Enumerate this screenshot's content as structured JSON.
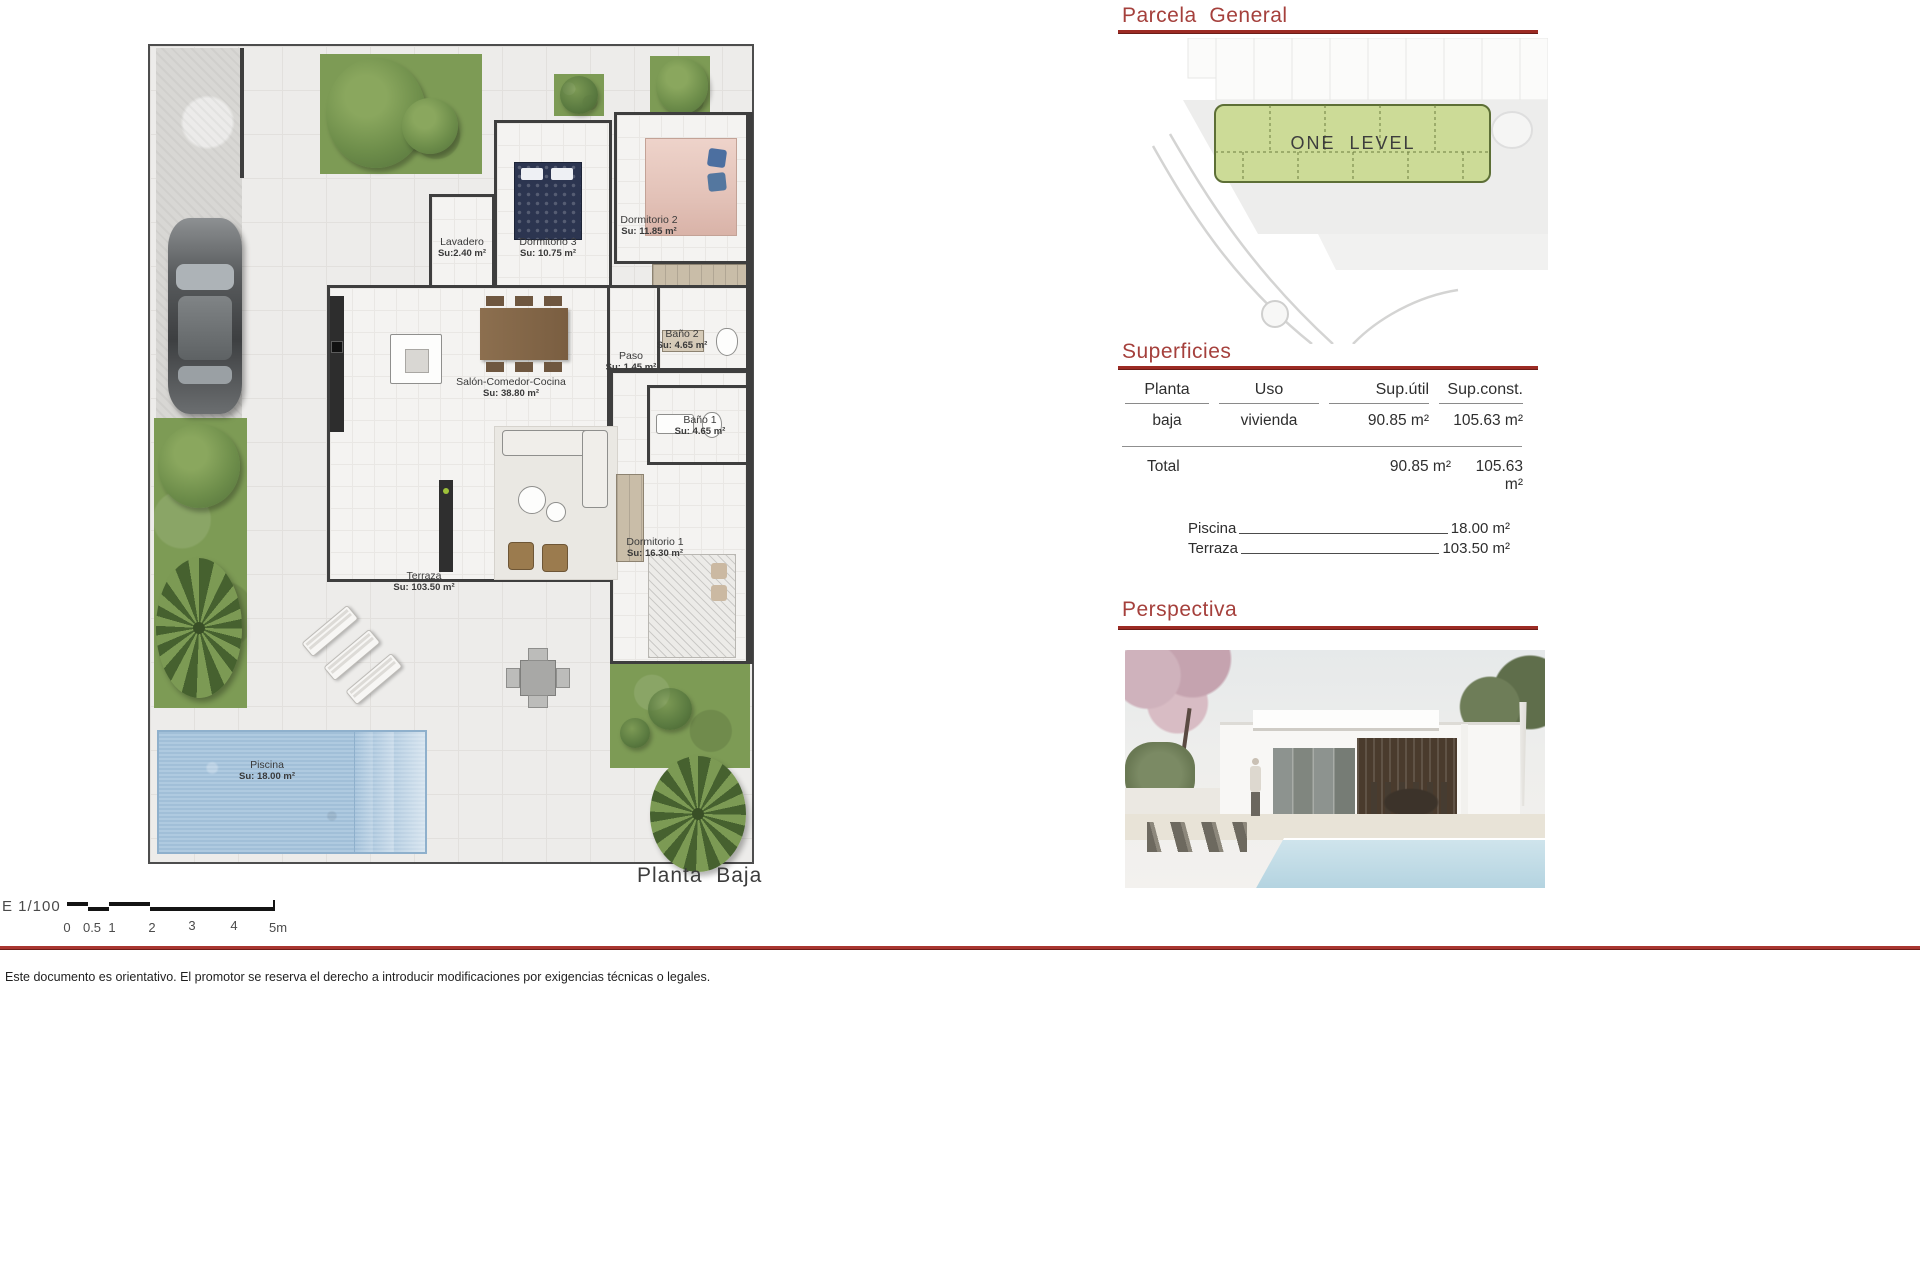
{
  "parcela": {
    "title": "Parcela  General",
    "plot_label": "ONE  LEVEL"
  },
  "superficies": {
    "title": "Superficies",
    "table": {
      "headers": [
        "Planta",
        "Uso",
        "Sup.útil",
        "Sup.const."
      ],
      "rows": [
        [
          "baja",
          "vivienda",
          "90.85 m²",
          "105.63 m²"
        ]
      ],
      "total_label": "Total",
      "total": [
        "90.85 m²",
        "105.63 m²"
      ]
    },
    "extras": [
      {
        "label": "Piscina",
        "value": "18.00 m²"
      },
      {
        "label": "Terraza",
        "value": "103.50 m²"
      }
    ]
  },
  "perspectiva": {
    "title": "Perspectiva"
  },
  "floor_plan": {
    "title": "Planta  Baja",
    "rooms": {
      "lavadero": {
        "name": "Lavadero",
        "area": "Su:2.40 m²"
      },
      "dorm3": {
        "name": "Dormitorio 3",
        "area": "Su: 10.75 m²"
      },
      "dorm2": {
        "name": "Dormitorio 2",
        "area": "Su: 11.85 m²"
      },
      "paso": {
        "name": "Paso",
        "area": "Su: 1.45 m²"
      },
      "bano2": {
        "name": "Baño 2",
        "area": "Su: 4.65 m²"
      },
      "salon": {
        "name": "Salón-Comedor-Cocina",
        "area": "Su: 38.80 m²"
      },
      "bano1": {
        "name": "Baño 1",
        "area": "Su: 4.65 m²"
      },
      "dorm1": {
        "name": "Dormitorio 1",
        "area": "Su: 16.30 m²"
      },
      "terraza": {
        "name": "Terraza",
        "area": "Su: 103.50 m²"
      },
      "piscina": {
        "name": "Piscina",
        "area": "Su: 18.00 m²"
      }
    }
  },
  "scale_bar": {
    "label": "E 1/100",
    "ticks": [
      "0",
      "0.5",
      "1",
      "2",
      "3",
      "4",
      "5m"
    ]
  },
  "footer": {
    "disclaimer": "Este documento es orientativo. El promotor se reserva el derecho a introducir modificaciones por exigencias técnicas o legales."
  },
  "colors": {
    "accent_red": "#a5403c",
    "rule_red": "#9c2b24",
    "grass_green": "#7d9b55",
    "plot_green": "#ccdb97",
    "pool_blue": "#a9c6de",
    "wall_dark": "#3e3e3e"
  }
}
